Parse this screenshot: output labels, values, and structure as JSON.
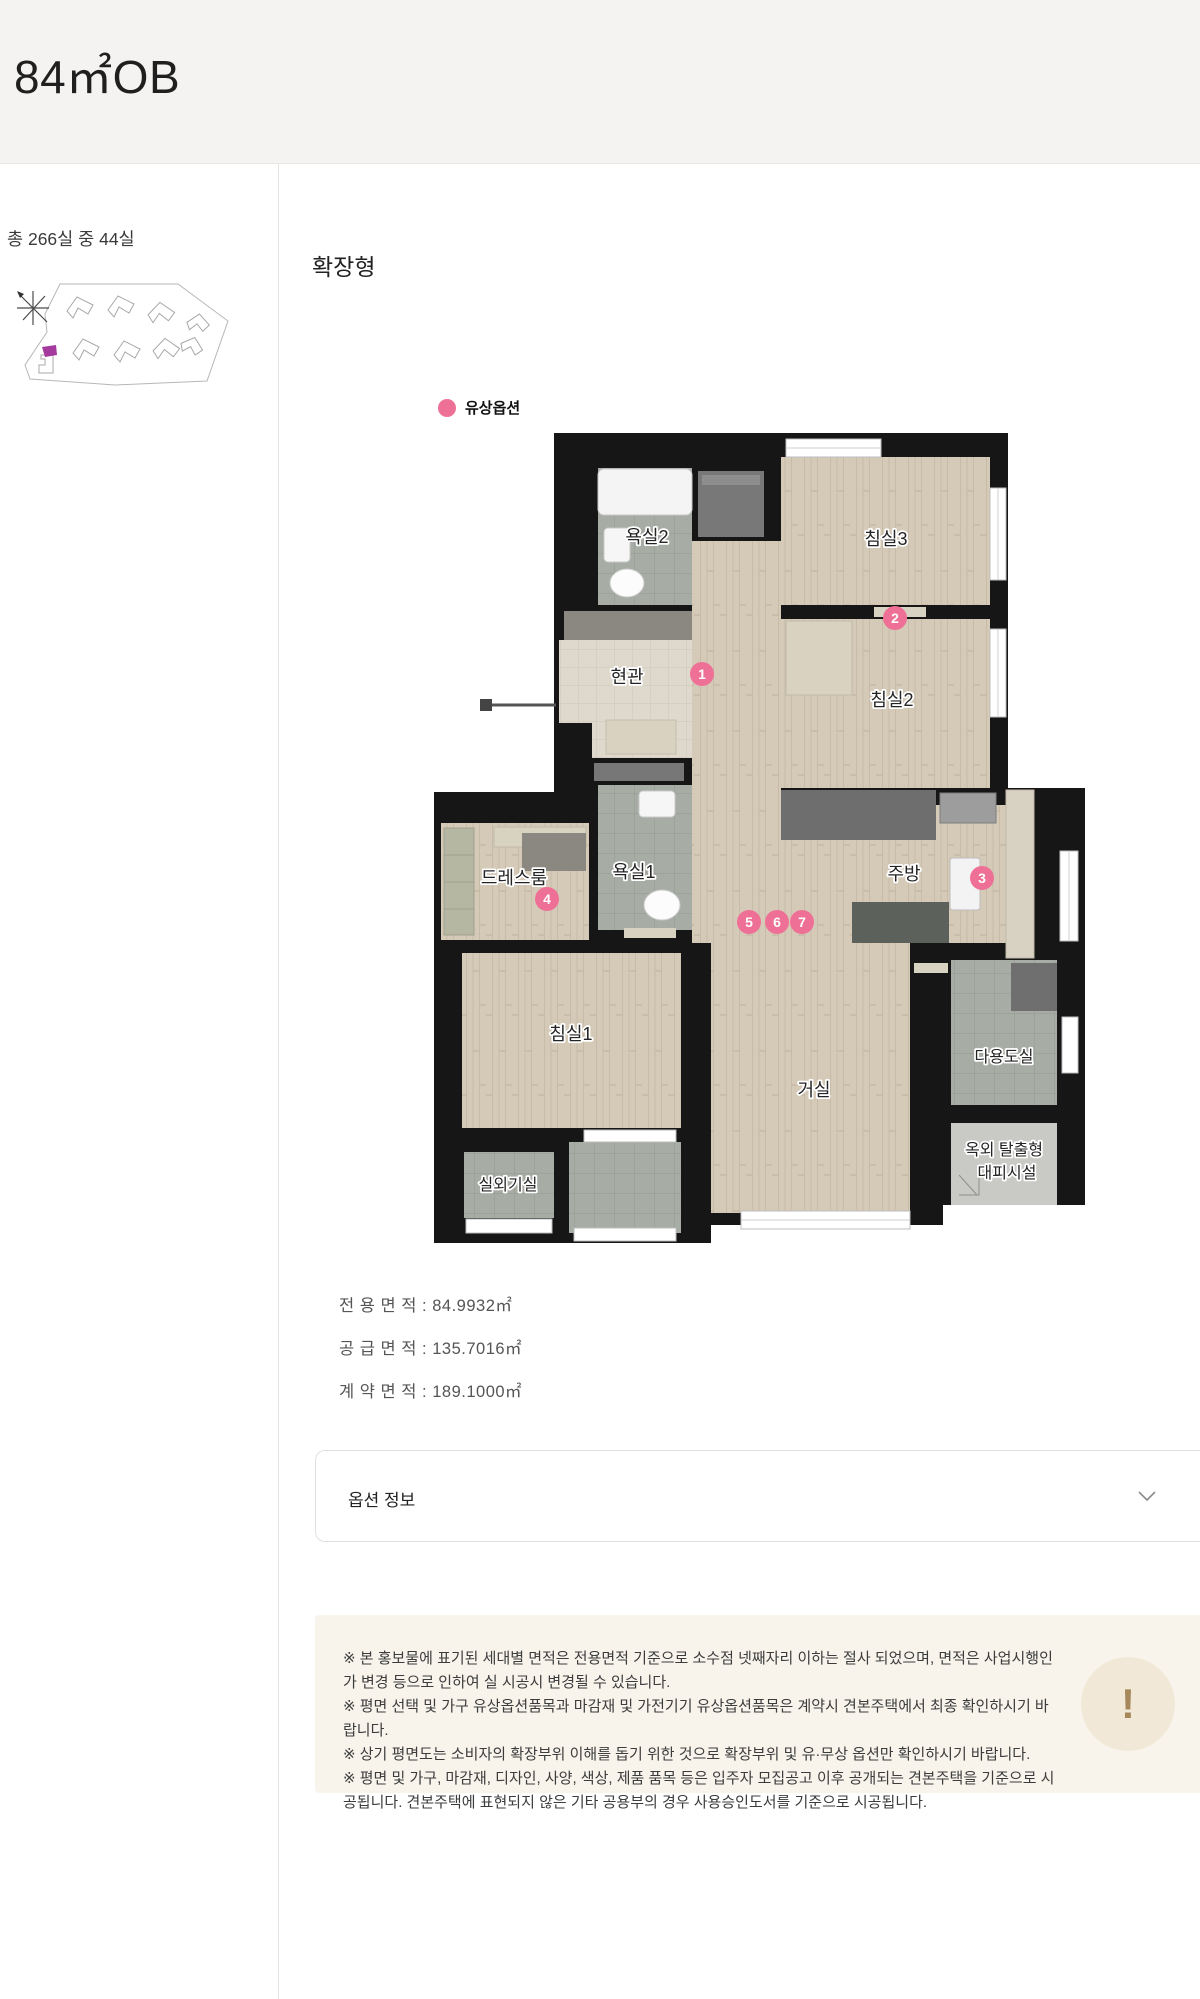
{
  "page": {
    "title": "84㎡OB"
  },
  "sidebar": {
    "availability": "총 266실 중 44실"
  },
  "content": {
    "plan_type_label": "확장형",
    "legend": {
      "label": "유상옵션"
    },
    "floorplan": {
      "rooms": {
        "bath2": {
          "label": "욕실2"
        },
        "bed3": {
          "label": "침실3"
        },
        "entrance": {
          "label": "현관"
        },
        "bed2": {
          "label": "침실2"
        },
        "dress": {
          "label": "드레스룸"
        },
        "bath1": {
          "label": "욕실1"
        },
        "kitchen": {
          "label": "주방"
        },
        "bed1": {
          "label": "침실1"
        },
        "living": {
          "label": "거실"
        },
        "utility": {
          "label": "다용도실"
        },
        "acroom": {
          "label": "실외기실"
        },
        "escape": {
          "label": "옥외 탈출형",
          "label2": "대피시설"
        }
      },
      "badges": [
        "1",
        "2",
        "3",
        "4",
        "5",
        "6",
        "7"
      ]
    },
    "areas": [
      {
        "text": "전 용 면 적 : 84.9932㎡"
      },
      {
        "text": "공 급 면 적 : 135.7016㎡"
      },
      {
        "text": "계 약 면 적 : 189.1000㎡"
      }
    ],
    "option_accordion": {
      "label": "옵션 정보"
    },
    "notice": {
      "icon": "!",
      "items": [
        "※ 본 홍보물에 표기된 세대별 면적은 전용면적 기준으로 소수점 넷째자리 이하는 절사 되었으며, 면적은 사업시행인가 변경 등으로 인하여 실 시공시 변경될 수 있습니다.",
        "※ 평면 선택 및 가구 유상옵션품목과 마감재 및 가전기기 유상옵션품목은 계약시 견본주택에서 최종 확인하시기 바랍니다.",
        "※ 상기 평면도는 소비자의 확장부위 이해를 돕기 위한 것으로 확장부위 및 유·무상 옵션만 확인하시기 바랍니다.",
        "※ 평면 및 가구, 마감재, 디자인, 사양, 색상, 제품 품목 등은 입주자 모집공고 이후 공개되는 견본주택을 기준으로 시공됩니다. 견본주택에 표현되지 않은 기타 공용부의 경우 사용승인도서를 기준으로 시공됩니다."
      ]
    }
  },
  "colors": {
    "accent_pink": "#ee7096",
    "marker_purple": "#a53a9e",
    "notice_bg": "#f8f4ec",
    "notice_icon": "#a6885b"
  }
}
